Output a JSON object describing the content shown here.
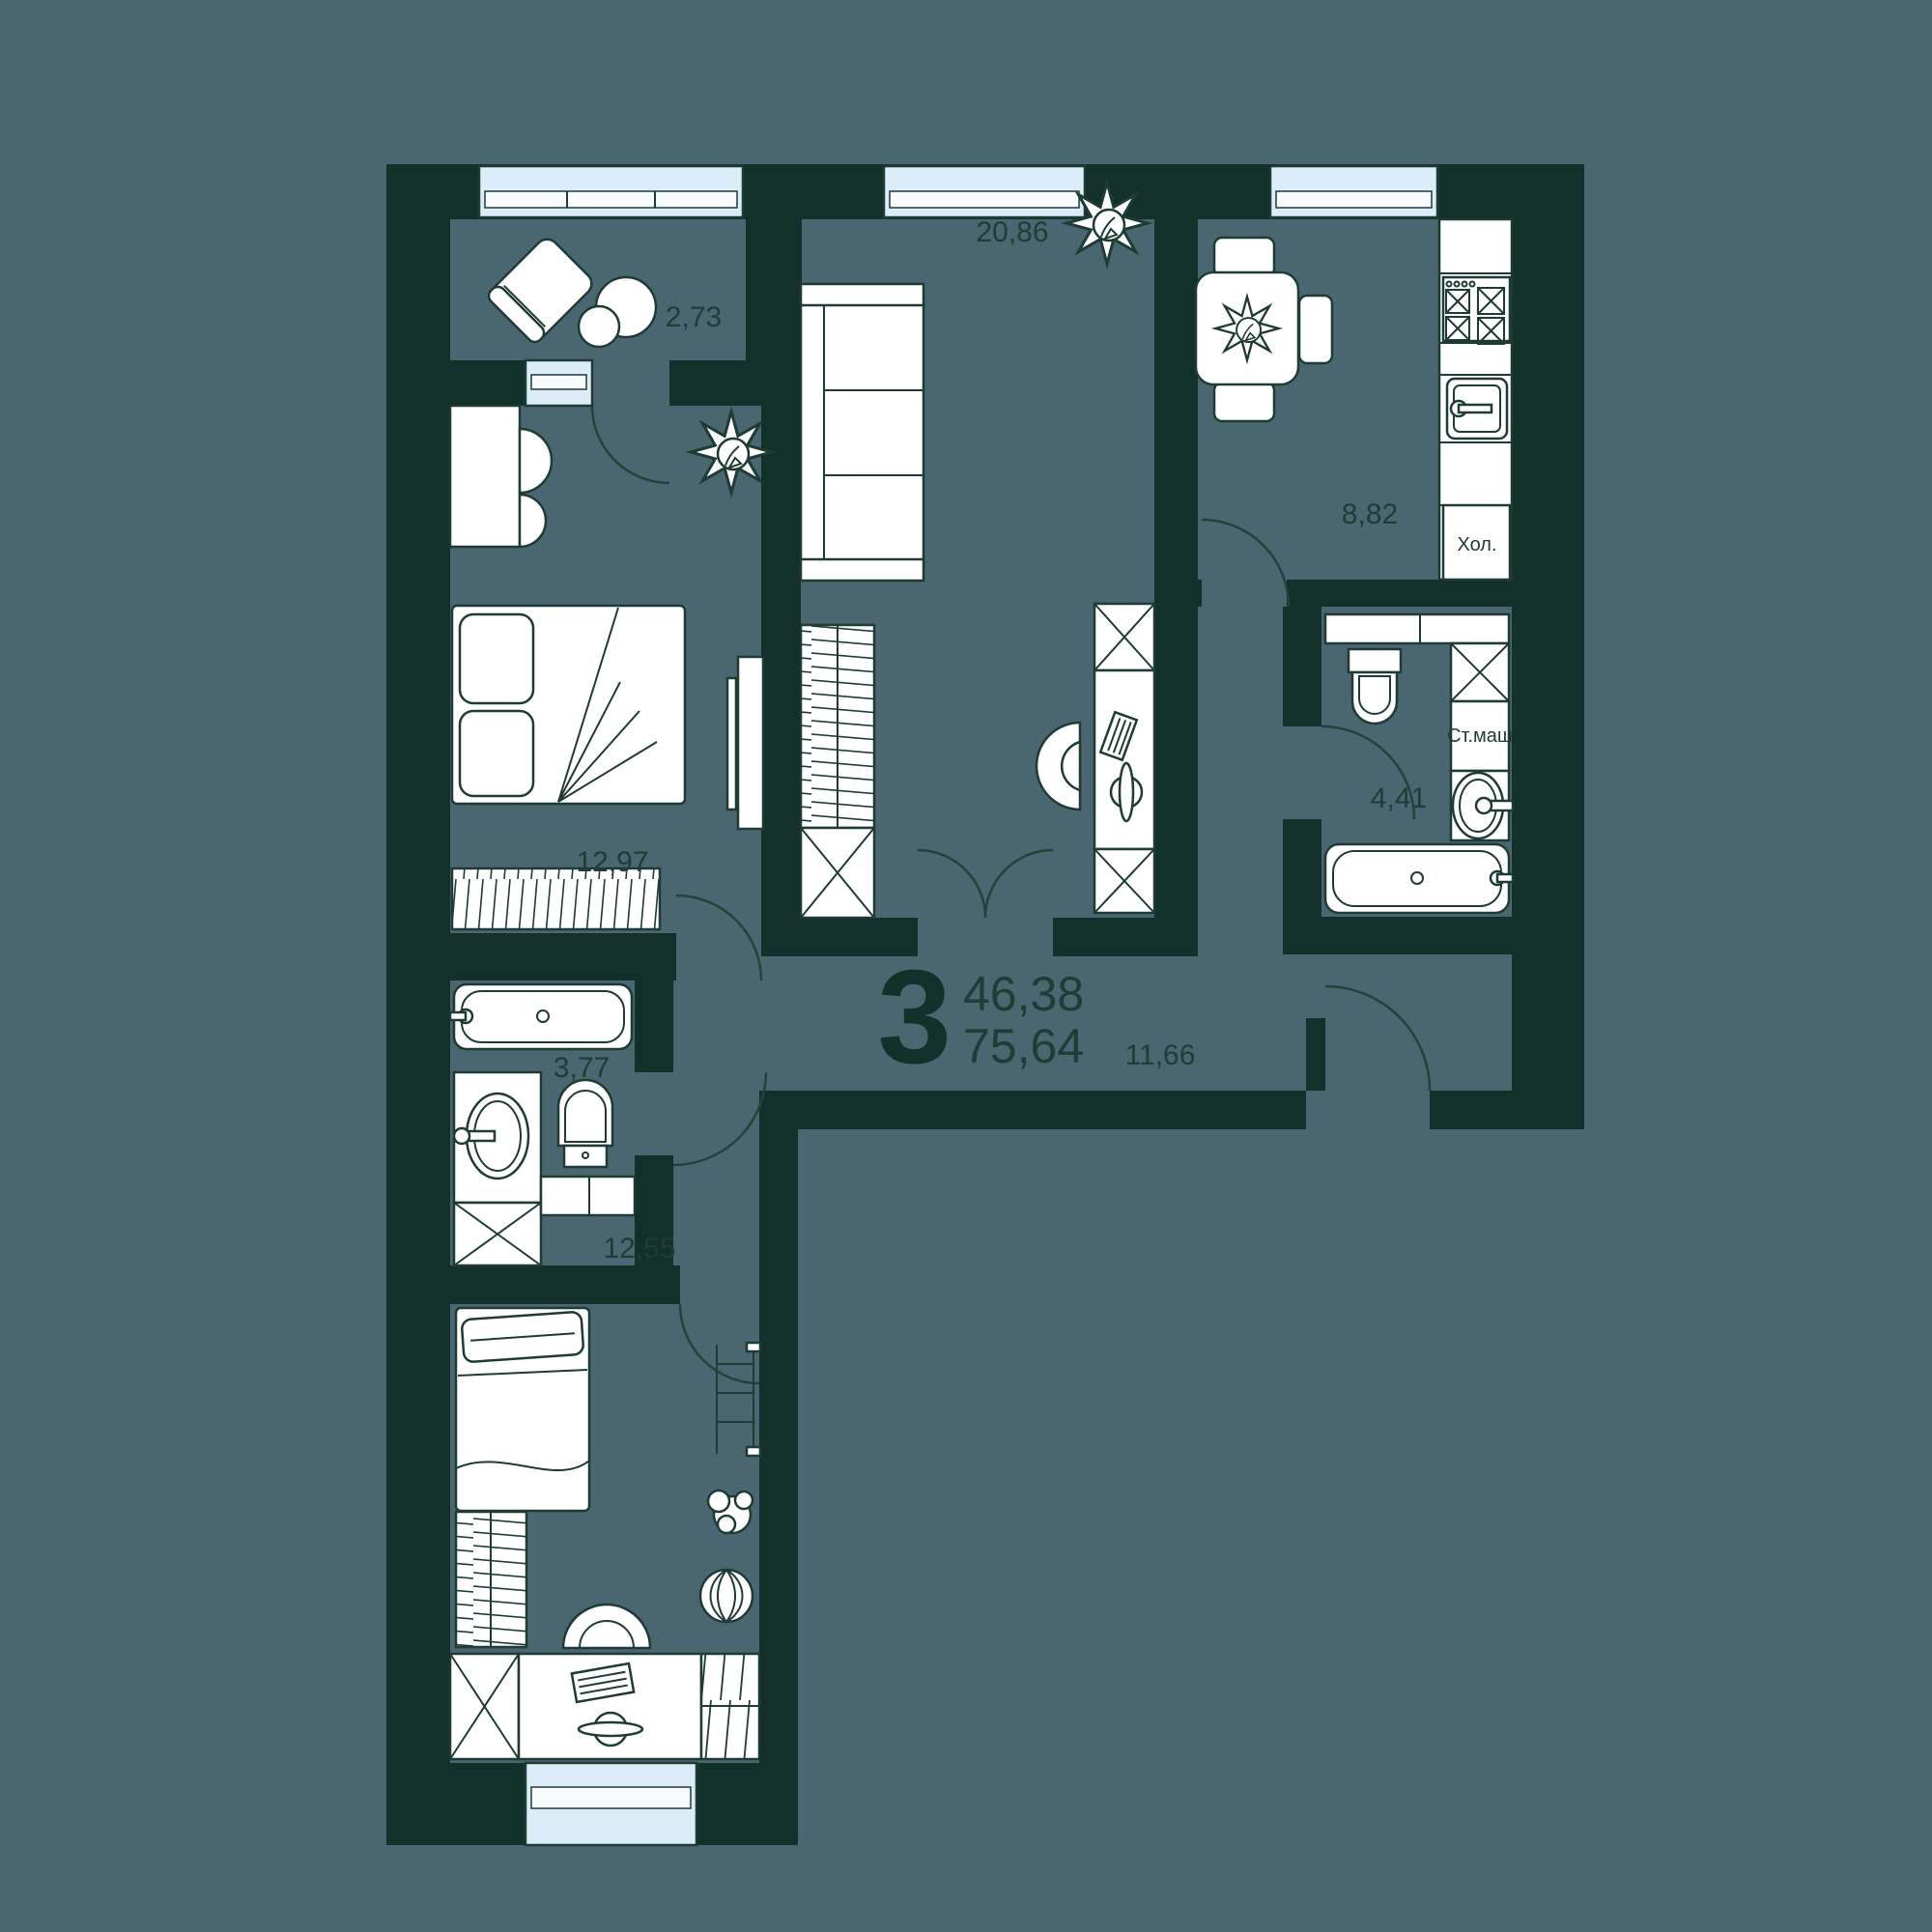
{
  "plan": {
    "type": "apartment-floor-plan",
    "summary": {
      "rooms_count": "3",
      "living_area": "46,38",
      "total_area": "75,64"
    },
    "rooms": [
      {
        "id": "balcony",
        "area": "2,73"
      },
      {
        "id": "bedroom",
        "area": "12,97"
      },
      {
        "id": "living",
        "area": "20,86"
      },
      {
        "id": "kitchen",
        "area": "8,82"
      },
      {
        "id": "bathroom-small",
        "area": "3,77"
      },
      {
        "id": "bathroom",
        "area": "4,41"
      },
      {
        "id": "hallway",
        "area": "11,66"
      },
      {
        "id": "bedroom-2",
        "area": "12,55"
      }
    ],
    "appliances": {
      "fridge": "Хол.",
      "washer": "Ст.маш"
    },
    "colors": {
      "background": "#4a6670",
      "walls": "#14302a",
      "lines": "#1e3b34",
      "furniture": "#ffffff",
      "windows": "#dcecf9",
      "labels": "#203c35"
    }
  }
}
